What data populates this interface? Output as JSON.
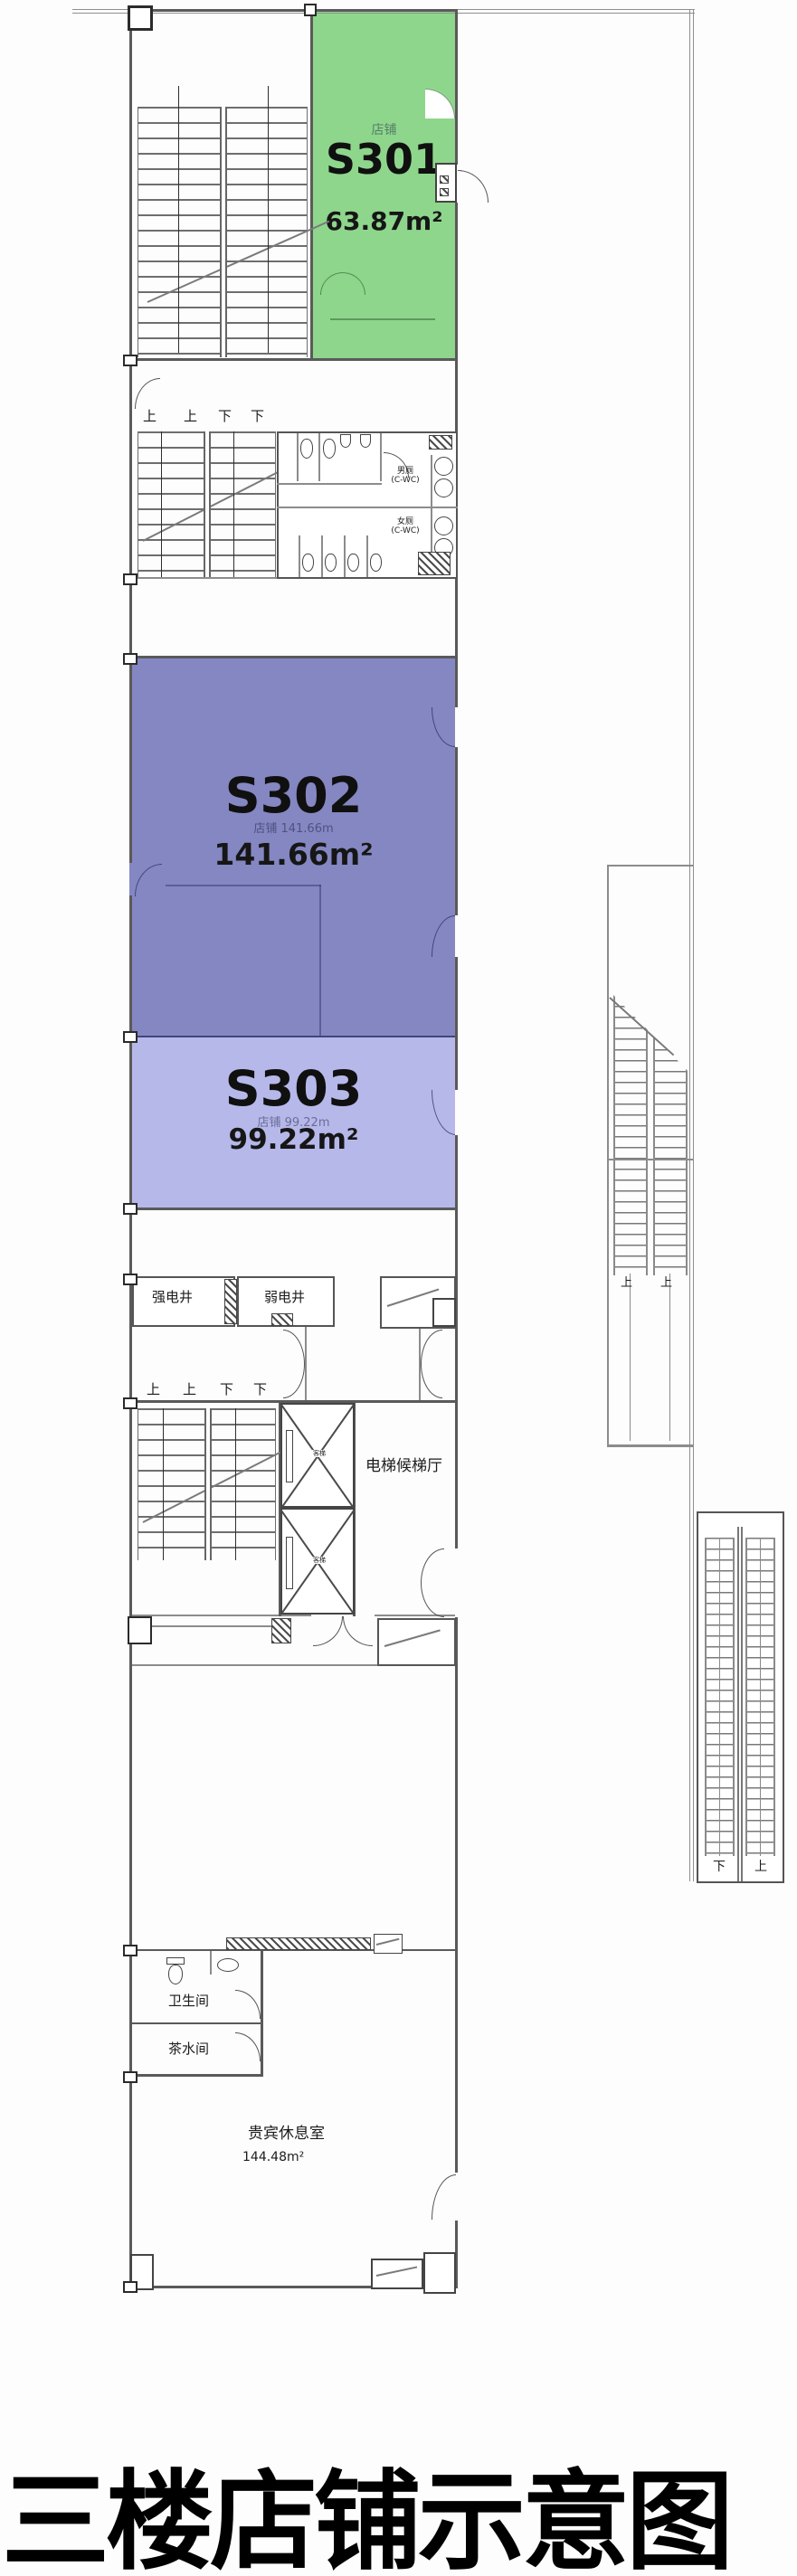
{
  "title": "三楼店铺示意图",
  "units": {
    "s301": {
      "id": "S301",
      "area": "63.87m²",
      "sub": "店铺"
    },
    "s302": {
      "id": "S302",
      "area": "141.66m²",
      "sub": "店铺 141.66m"
    },
    "s303": {
      "id": "S303",
      "area": "99.22m²",
      "sub": "店铺 99.22m"
    }
  },
  "labels": {
    "up": "上",
    "down": "下",
    "strong_shaft": "强电井",
    "weak_shaft": "弱电井",
    "elevator_hall": "电梯候梯厅",
    "elevator_car": "客梯",
    "male_wc": "男厕",
    "female_wc": "女厕",
    "wc_code": "(C-WC)",
    "toilet_room": "卫生间",
    "tea_room": "茶水间",
    "vip_room": "贵宾休息室",
    "vip_area": "144.48m²"
  },
  "colors": {
    "s301": "#8ed68c",
    "s302": "#8487c1",
    "s303": "#b6b8ea"
  }
}
